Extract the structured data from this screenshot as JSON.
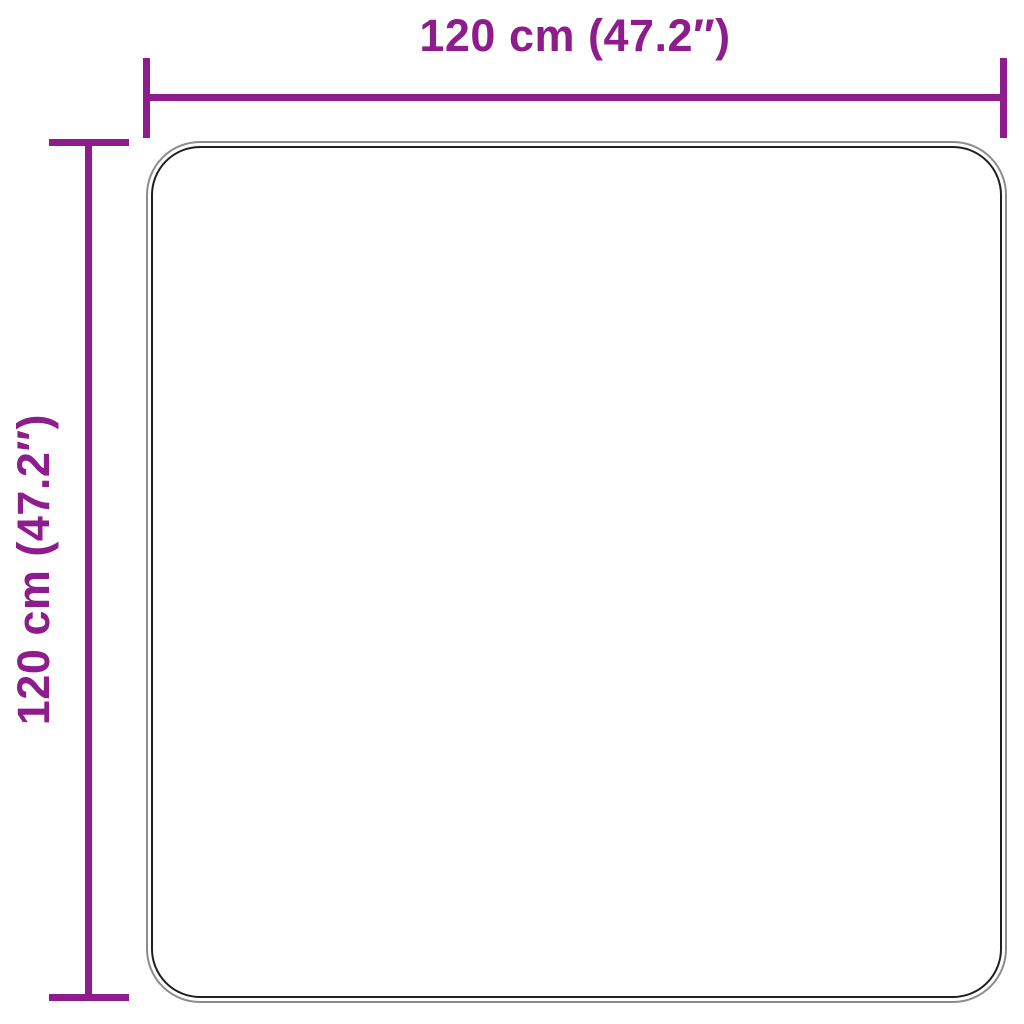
{
  "diagram": {
    "type": "product-dimension-diagram",
    "subject": "square rug top view",
    "width_label": "120 cm (47.2″)",
    "height_label": "120 cm (47.2″)",
    "dimensions": {
      "width_cm": 120,
      "width_in": 47.2,
      "height_cm": 120,
      "height_in": 47.2
    },
    "colors": {
      "accent": "#8E1C8C",
      "outline_outer": "#8C8C8C",
      "outline_inner": "#1F1F1F",
      "background": "#FFFFFF"
    }
  }
}
